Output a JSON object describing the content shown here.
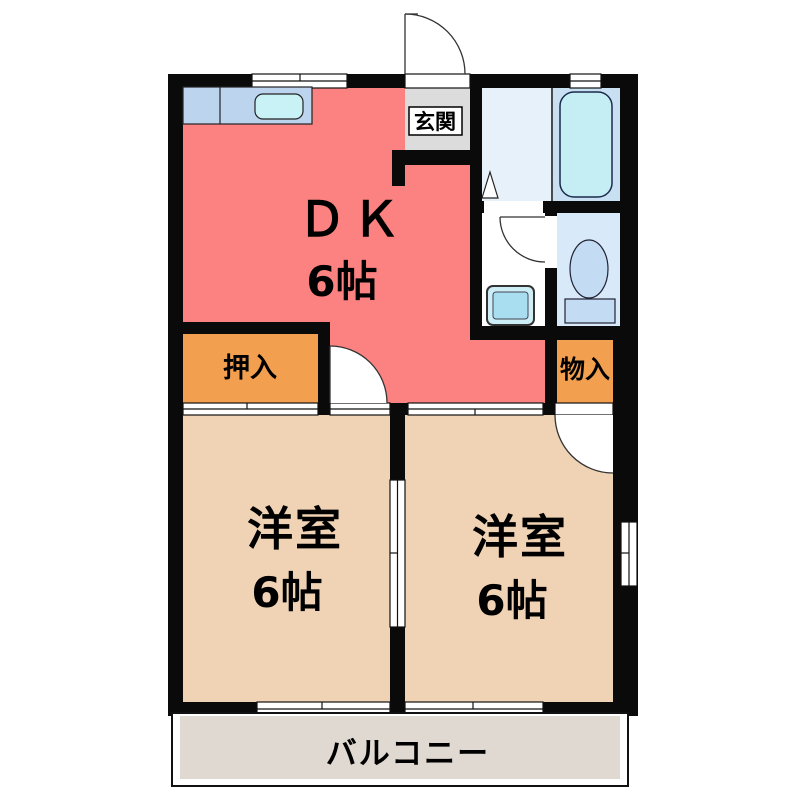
{
  "plan": {
    "type": "apartment-floorplan",
    "dk": {
      "label": "ＤＫ",
      "size": "6帖"
    },
    "room_left": {
      "label": "洋室",
      "size": "6帖"
    },
    "room_right": {
      "label": "洋室",
      "size": "6帖"
    },
    "genkan": {
      "label": "玄関"
    },
    "oshiire": {
      "label": "押入"
    },
    "monoire": {
      "label": "物入"
    },
    "balcony": {
      "label": "バルコニー"
    }
  },
  "colors": {
    "wall": "#0A0A0A",
    "dk": "#FC8181",
    "western_room": "#F0D2B4",
    "closet": "#F2A050",
    "genkan": "#DCDCDC",
    "balcony": "#E0D9D1",
    "washroom": "#E7F1FA",
    "bathroom": "#C9E0F3",
    "toilet_room": "#D8E9FA",
    "bathtub": "#C4EDF4",
    "kitchen_counter": "#BCD4EE",
    "sink": "#C8F2F6",
    "toilet_fixture": "#C4DBF4",
    "washer_pan": "#CDEEF6",
    "washer_tub": "#A8DEF0"
  }
}
